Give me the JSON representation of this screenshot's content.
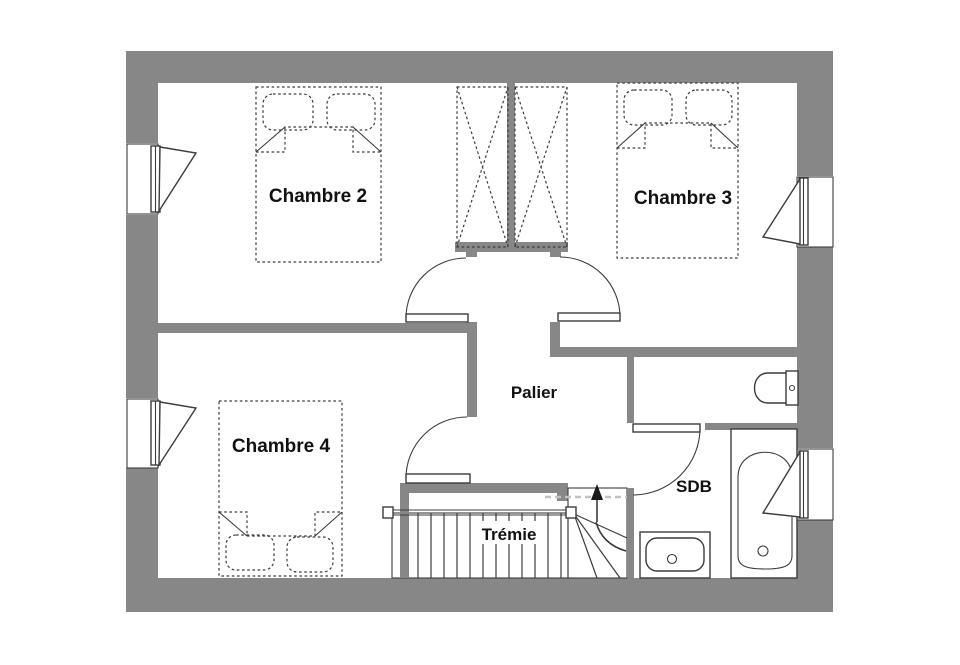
{
  "plan": {
    "rooms": [
      {
        "id": "chambre-2",
        "label": "Chambre 2"
      },
      {
        "id": "chambre-3",
        "label": "Chambre 3"
      },
      {
        "id": "chambre-4",
        "label": "Chambre 4"
      },
      {
        "id": "palier",
        "label": "Palier"
      },
      {
        "id": "tremie",
        "label": "Trémie"
      },
      {
        "id": "sdb",
        "label": "SDB"
      }
    ],
    "colors": {
      "wall": "#878787",
      "line": "#3c3c3c",
      "background": "#ffffff",
      "guide": "#c2c2c2",
      "text": "#111111"
    }
  }
}
